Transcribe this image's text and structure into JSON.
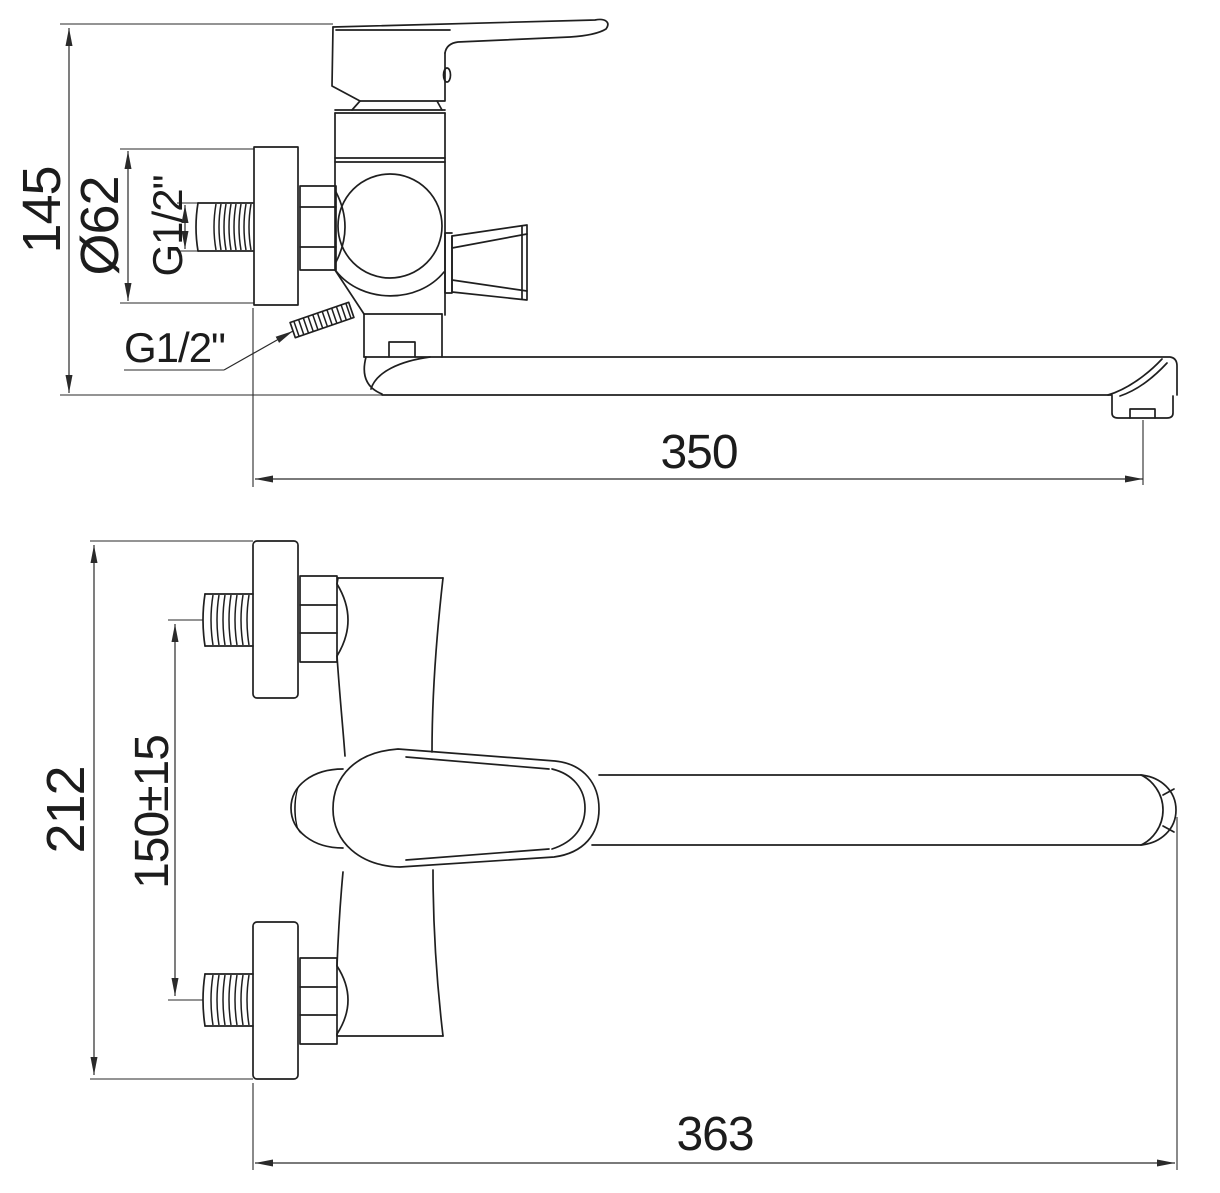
{
  "page": {
    "title": "Wall-mounted bath mixer dimensional drawing",
    "background_color": "#ffffff",
    "line_color": "#1f1f1f"
  },
  "side_view": {
    "dim_total_height": "145",
    "dim_flange_diameter": "Ø62",
    "dim_thread_size_rotated": "G1/2\"",
    "dim_thread_size_leader": "G1/2\"",
    "dim_spout_reach": "350"
  },
  "front_view": {
    "dim_overall_height": "212",
    "dim_connection_spacing": "150±15",
    "dim_overall_length": "363"
  }
}
